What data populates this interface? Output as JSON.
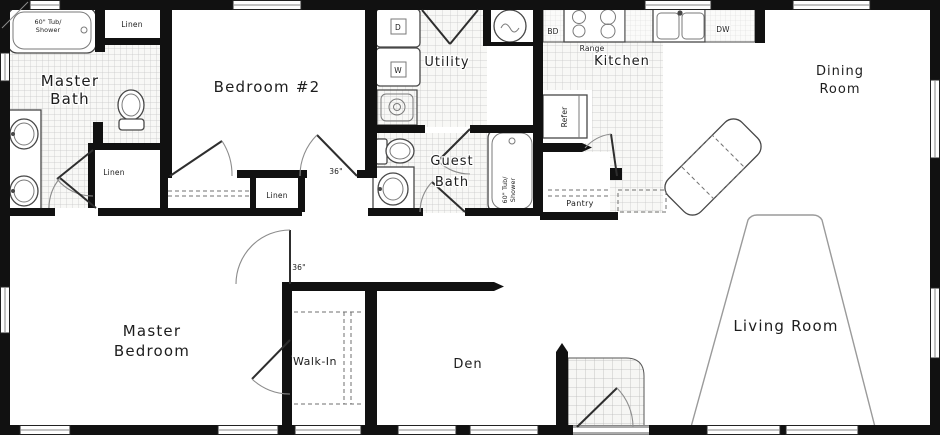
{
  "title": "Single-story home floor plan",
  "colors": {
    "wall": "#111111",
    "fixture_outline": "#474747",
    "tile_line": "#c6c6c6",
    "door_arc": "#8c8c8c",
    "label_text": "#1d1d1d",
    "background": "#ffffff"
  },
  "rooms": [
    "Master Bath",
    "Bedroom #2",
    "Utility",
    "Kitchen",
    "Dining Room",
    "Guest Bath",
    "Pantry",
    "Master Bedroom",
    "Walk-In",
    "Den",
    "Living Room"
  ],
  "labels": {
    "master_bath_1": "Master",
    "master_bath_2": "Bath",
    "master_tub_1": "60\" Tub/",
    "master_tub_2": "Shower",
    "guest_tub_1": "60\" Tub/",
    "guest_tub_2": "Shower",
    "linen_top": "Linen",
    "linen_hall": "Linen",
    "linen_bed2": "Linen",
    "bedroom2": "Bedroom #2",
    "utility": "Utility",
    "dryer": "D",
    "washer": "W",
    "bd": "BD",
    "range": "Range",
    "dw": "DW",
    "refer": "Refer",
    "kitchen": "Kitchen",
    "dining_1": "Dining",
    "dining_2": "Room",
    "guest_bath_1": "Guest",
    "guest_bath_2": "Bath",
    "pantry": "Pantry",
    "door_36_a": "36\"",
    "door_36_b": "36\"",
    "master_bedroom_1": "Master",
    "master_bedroom_2": "Bedroom",
    "walk_in": "Walk-In",
    "den": "Den",
    "living_room": "Living Room"
  }
}
